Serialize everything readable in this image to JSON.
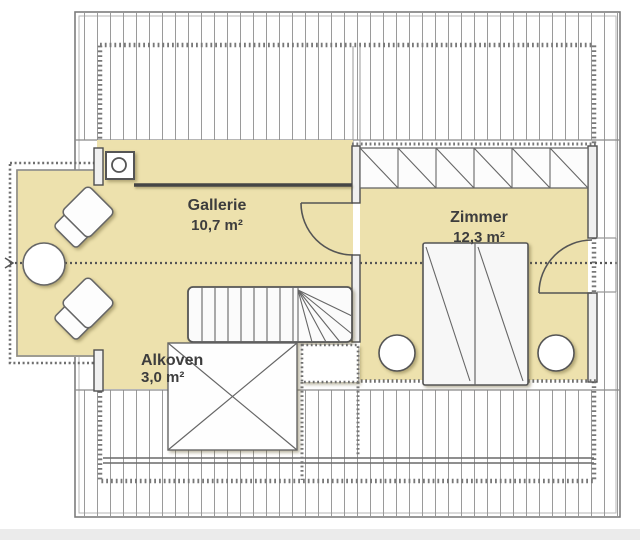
{
  "floorplan": {
    "title": "attic-floor-plan",
    "rooms": [
      {
        "name": "Gallerie",
        "area": "10,7 m²"
      },
      {
        "name": "Zimmer",
        "area": "12,3 m²"
      },
      {
        "name": "Alkoven",
        "area": "3,0 m²"
      }
    ],
    "furniture": [
      "chimney",
      "wardrobe-row",
      "staircase-with-winders",
      "double-bed",
      "bedside-table-left",
      "bedside-table-right",
      "balcony-round-table",
      "balcony-armchair-top",
      "balcony-armchair-bottom",
      "cross-marked-alcove-box"
    ],
    "doors": [
      "door-gallerie-to-zimmer",
      "door-zimmer-exterior"
    ],
    "colors": {
      "floor": "#EDE1AD",
      "hatch": "#9a9a9a",
      "wall": "#4f4f4f",
      "dashed_outline": "#787878",
      "text": "#3d3d3d",
      "background": "#ffffff",
      "footer_strip": "#ebebeb"
    }
  }
}
